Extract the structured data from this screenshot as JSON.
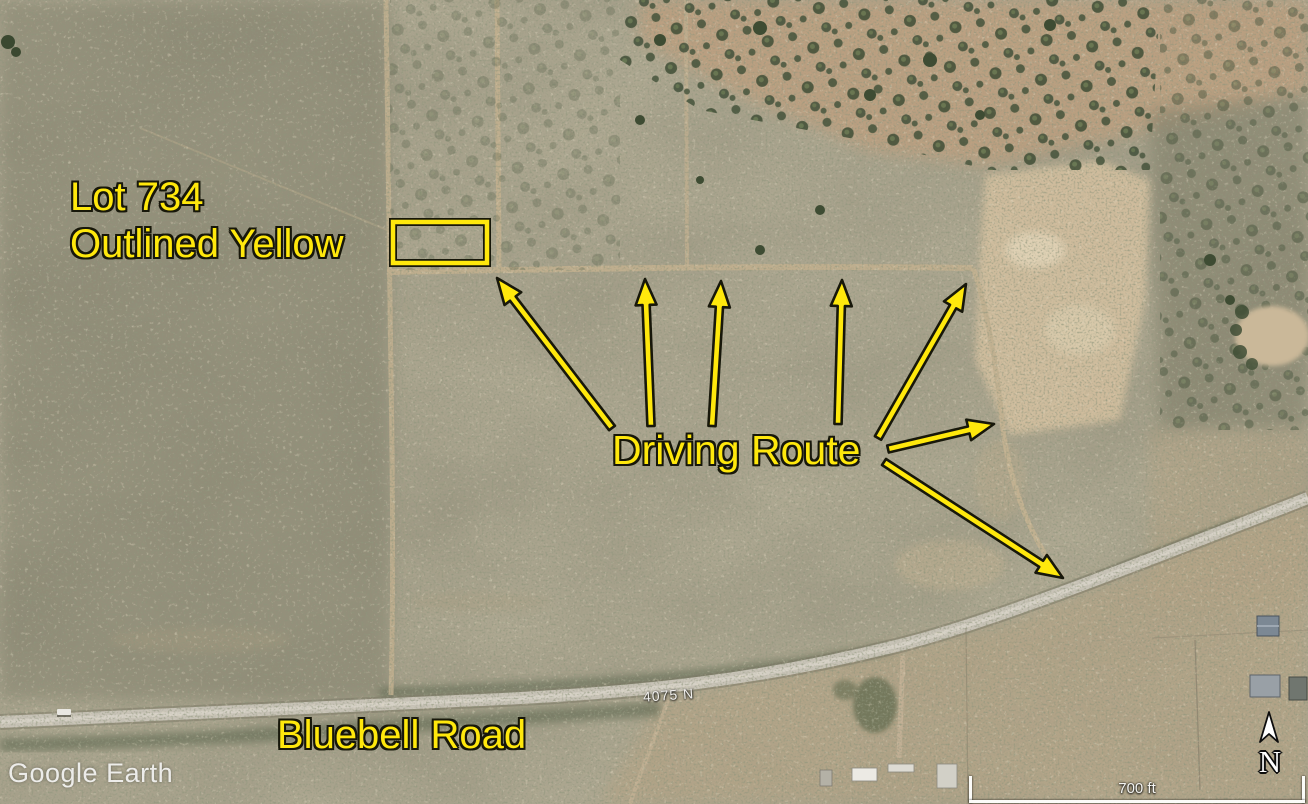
{
  "watermark": {
    "text": "Google Earth"
  },
  "annotations": {
    "lot": {
      "line1": "Lot 734",
      "line2": "Outlined Yellow"
    },
    "driving_route": {
      "label": "Driving Route",
      "arrow_count": 7
    },
    "road": {
      "label": "Bluebell Road"
    },
    "street_sign": {
      "label": "4075 N"
    }
  },
  "map_controls": {
    "compass": {
      "label": "N"
    },
    "scale_bar": {
      "label": "700 ft"
    }
  },
  "colors": {
    "annotation_yellow": "#ffe80c",
    "annotation_outline": "#17170a"
  }
}
